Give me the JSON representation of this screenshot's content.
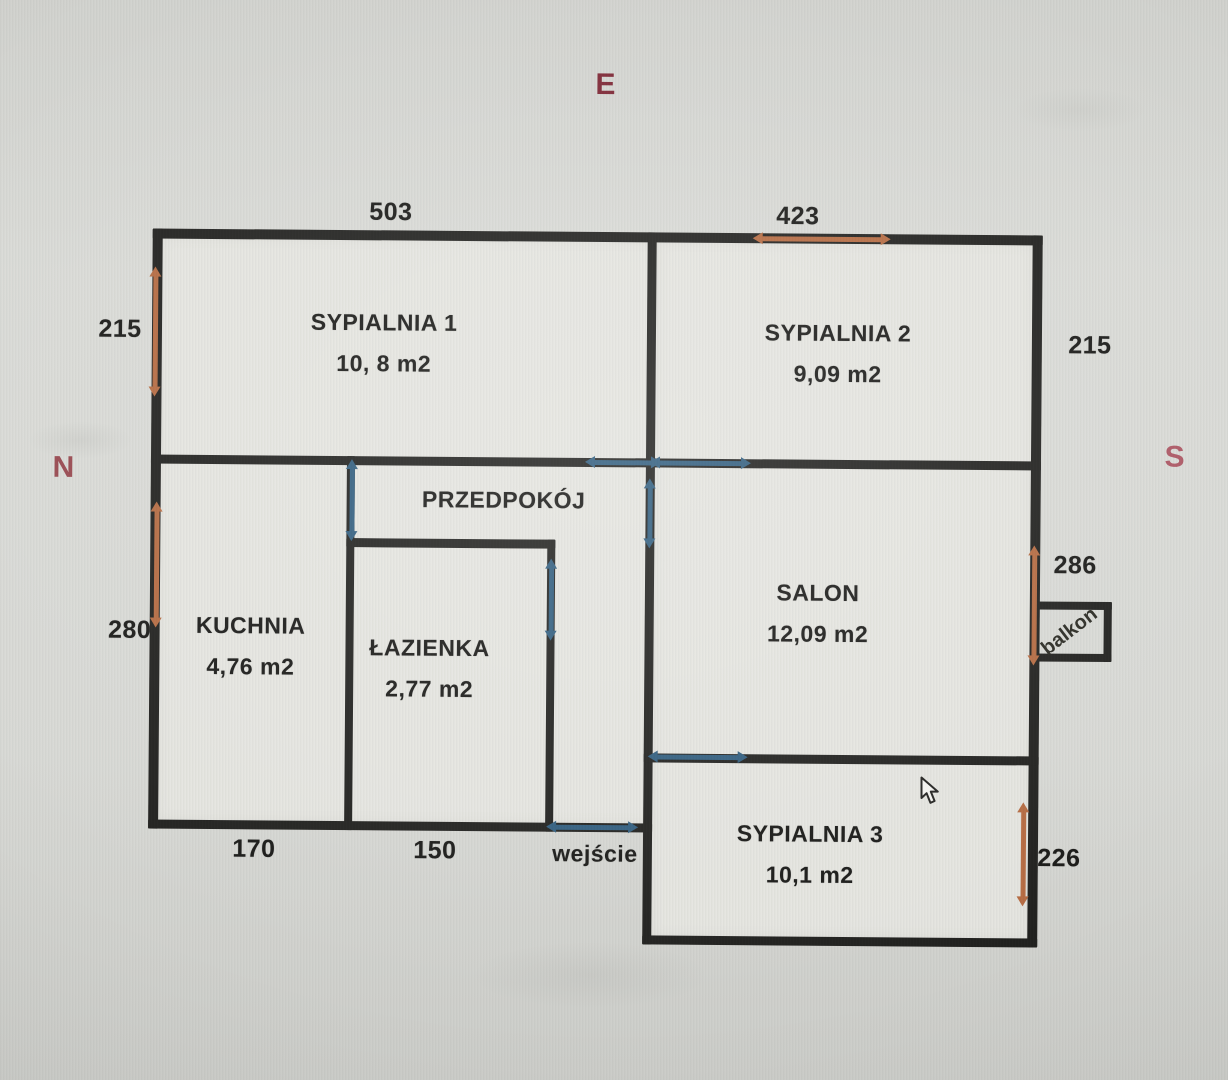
{
  "compass": {
    "east": "E",
    "north": "N",
    "south": "S"
  },
  "rooms": [
    {
      "name": "SYPIALNIA 1",
      "area": "10, 8 m2"
    },
    {
      "name": "SYPIALNIA 2",
      "area": "9,09 m2"
    },
    {
      "name": "PRZEDPOKÓJ",
      "area": ""
    },
    {
      "name": "KUCHNIA",
      "area": "4,76 m2"
    },
    {
      "name": "ŁAZIENKA",
      "area": "2,77 m2"
    },
    {
      "name": "SALON",
      "area": "12,09 m2"
    },
    {
      "name": "SYPIALNIA 3",
      "area": "10,1 m2"
    }
  ],
  "dimensions_cm": {
    "syp1_top": "503",
    "syp2_top": "423",
    "left_upper": "215",
    "right_upper": "215",
    "left_lower": "280",
    "salon_right": "286",
    "syp3_right": "226",
    "kuchnia_bottom": "170",
    "lazienka_bottom": "150"
  },
  "annotations": {
    "entrance": "wejście",
    "balcony": "balkon"
  },
  "colors": {
    "wall": "#1d1d1b",
    "door_arrow_blue": "#2d5b7d",
    "dimension_arrow_orange": "#b5693f",
    "compass_east": "#7d2533",
    "compass_north": "#97464d",
    "compass_south": "#ad5663",
    "plan_paper": "#e5e5e0",
    "photo_background": "#d8d9d5"
  }
}
